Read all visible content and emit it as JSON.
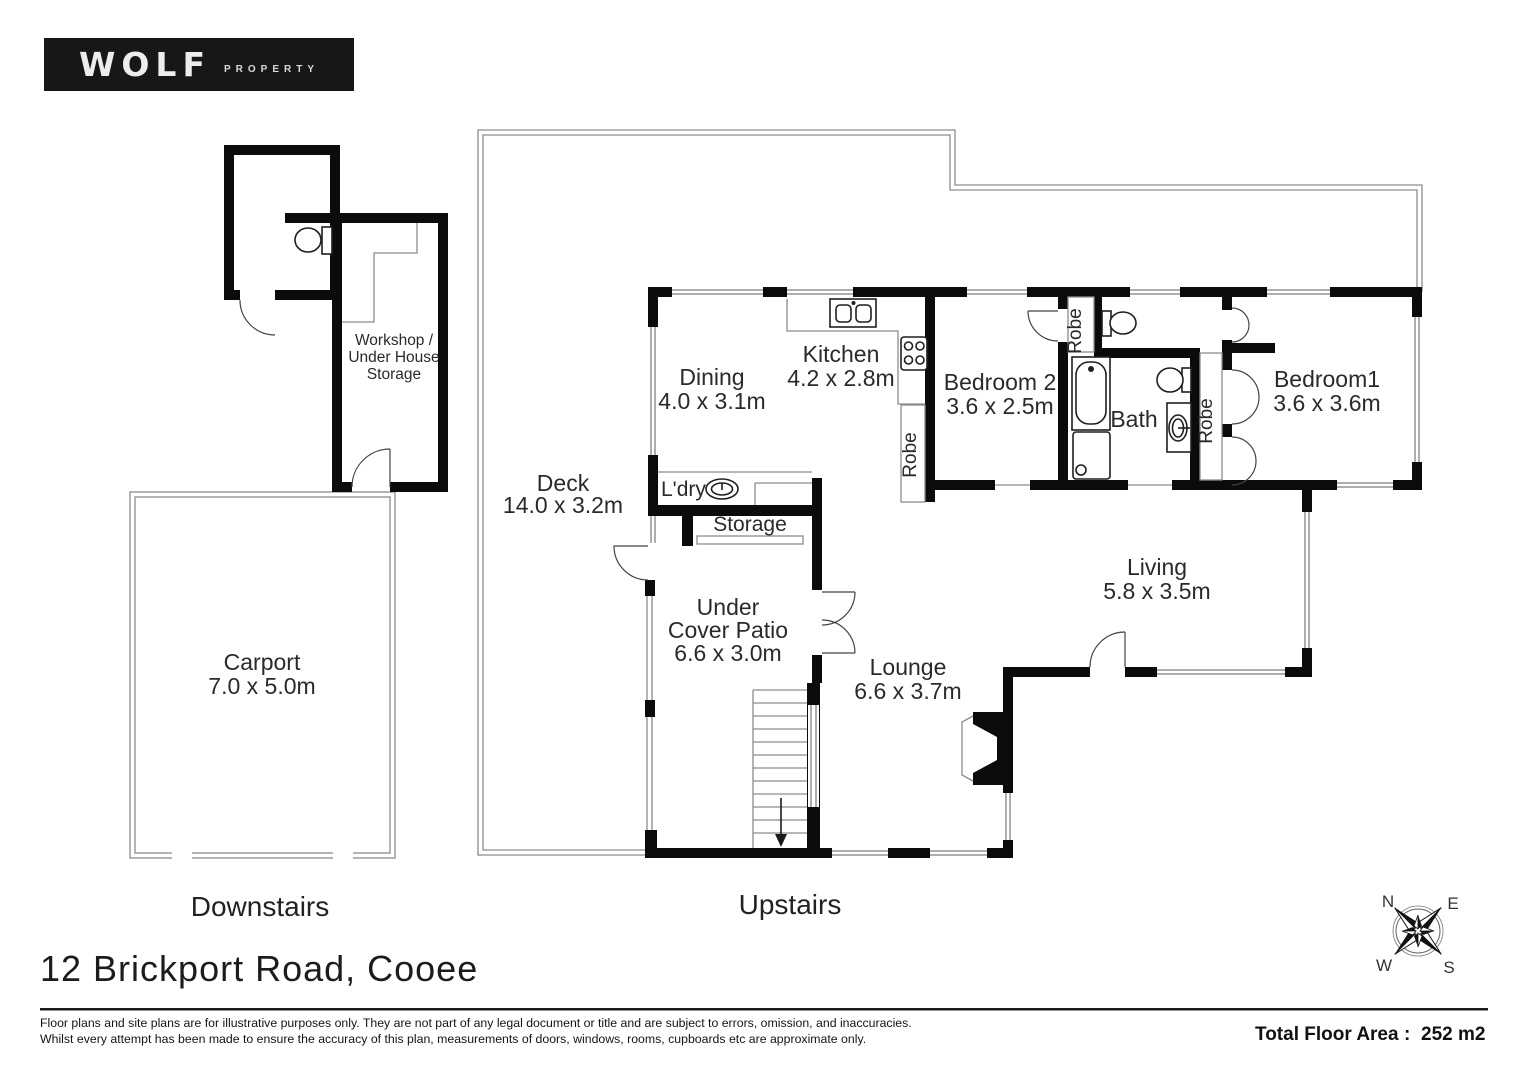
{
  "logo": {
    "brand": "WOLF",
    "tagline": "PROPERTY"
  },
  "plan": {
    "downstairs_label": "Downstairs",
    "upstairs_label": "Upstairs",
    "rooms": {
      "workshop_line1": "Workshop /",
      "workshop_line2": "Under House",
      "workshop_line3": "Storage",
      "carport_name": "Carport",
      "carport_dims": "7.0 x 5.0m",
      "deck_name": "Deck",
      "deck_dims": "14.0 x 3.2m",
      "dining_name": "Dining",
      "dining_dims": "4.0 x 3.1m",
      "kitchen_name": "Kitchen",
      "kitchen_dims": "4.2 x 2.8m",
      "bedroom2_name": "Bedroom 2",
      "bedroom2_dims": "3.6 x 2.5m",
      "bedroom1_name": "Bedroom1",
      "bedroom1_dims": "3.6 x 3.6m",
      "bath_name": "Bath",
      "living_name": "Living",
      "living_dims": "5.8 x 3.5m",
      "lounge_name": "Lounge",
      "lounge_dims": "6.6 x 3.7m",
      "patio_line1": "Under",
      "patio_line2": "Cover Patio",
      "patio_line3": "6.6 x 3.0m",
      "storage_name": "Storage",
      "laundry_name": "L'dry",
      "robe_label": "Robe"
    },
    "compass": {
      "n": "N",
      "e": "E",
      "s": "S",
      "w": "W"
    }
  },
  "address": "12 Brickport Road, Cooee",
  "footer": {
    "disclaimer_line1": "Floor plans and site plans are for illustrative purposes only. They are not part of any legal document or title and are subject to errors, omission, and inaccuracies.",
    "disclaimer_line2": "Whilst every attempt has been made to ensure the accuracy of this plan, measurements of doors, windows, rooms, cupboards etc are approximate only.",
    "total_area_label": "Total Floor Area",
    "total_area_separator": ":",
    "total_area_value": "252 m2"
  }
}
